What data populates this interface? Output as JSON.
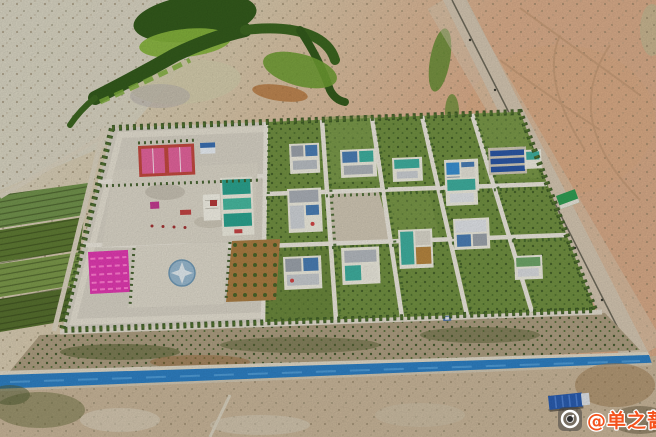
{
  "image": {
    "kind": "aerial-drone-photograph",
    "subject": "new desert settlement compound with tree-lined plots, courtyard houses, sports courts, plazas and an irrigation canal"
  },
  "watermark": {
    "icon": "camera-icon",
    "text": "@单之蔷",
    "text_color": "#f4531d",
    "outline_color": "#ffffff"
  },
  "colors": {
    "desert_pale": "#d7d3c1",
    "desert_sand": "#d6c7aa",
    "desert_pink": "#d9ac8a",
    "desert_bottom": "#c7b498",
    "wetland_bright": "#86b33c",
    "wetland_mid": "#5d8a2d",
    "wetland_dark": "#335a1c",
    "wetland_sand": "#d3cbab",
    "wetland_orange": "#b5763c",
    "field_green_1": "#71924c",
    "field_green_2": "#5e7a33",
    "field_green_3": "#7b984a",
    "field_green_4": "#566f2e",
    "road_gravel": "#cfc2ad",
    "road_line": "#5a584a",
    "compound_ground": "#d6d1c4",
    "plaza": "#dad5c7",
    "path_white": "#eae6db",
    "tree_green": "#3c5a26",
    "tree_bright": "#55772f",
    "plot_green": "#708f41",
    "plot_green_light": "#82a050",
    "plot_green_dark": "#647f37",
    "dirt_plot": "#cfc6b3",
    "scrub_strip": "#ac9d80",
    "scrub_dark": "#5c6637",
    "court_red": "#c2493f",
    "court_pink": "#e2639b",
    "magenta_plot": "#e03ab0",
    "magenta_light": "#ff7ad0",
    "brown_plot": "#a87c42",
    "emblem_blue": "#93b6ce",
    "building_teal": "#2ba28e",
    "building_teal_light": "#47b89f",
    "house_white": "#eceadd",
    "roof_gray": "#9ba2aa",
    "roof_blue": "#4a7db3",
    "roof_teal": "#3fae9e",
    "roof_green": "#6ea568",
    "pool_blue": "#3a8fd0",
    "solar_blue": "#2b57a4",
    "gate_green": "#2f9d53",
    "canal_blue": "#2e7fc2",
    "canal_light": "#5ea6dd",
    "canal_bank": "#ded7c6",
    "truck_blue": "#2a5cae"
  }
}
